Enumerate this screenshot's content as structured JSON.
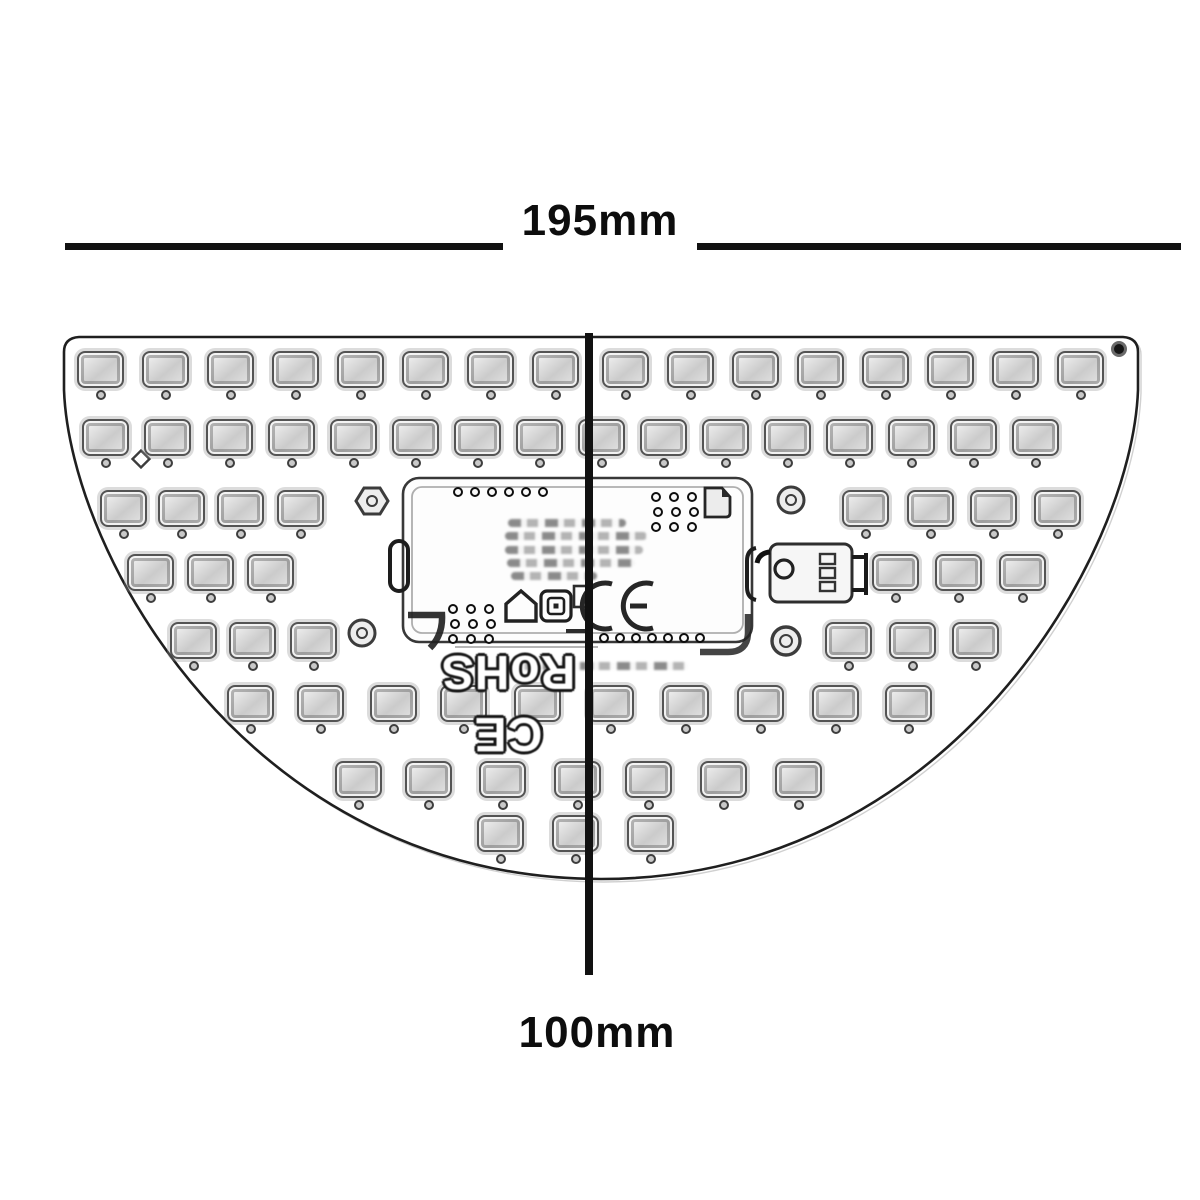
{
  "page": {
    "type": "technical-dimension-diagram",
    "subject": "Semicircular LED module PCB, sketch-style line drawing",
    "background": "#ffffff"
  },
  "dimensions": {
    "width_label": "195mm",
    "height_label": "100mm"
  },
  "board": {
    "shape": "half-moon (flat top edge, circular bottom arc)",
    "silkscreen_text": "CE RoHS",
    "silkscreen_rotation_deg": 180,
    "ce_mark": "CE",
    "icons": [
      "house-icon",
      "square-spiral-icon",
      "enclosure-icon",
      "page-curl-icon",
      "ce-mark-icon"
    ],
    "led_rows": [
      {
        "cy": 369,
        "cx": [
          100,
          165,
          230,
          295,
          360,
          425,
          490,
          555,
          625,
          690,
          755,
          820,
          885,
          950,
          1015,
          1080
        ]
      },
      {
        "cy": 437,
        "cx": [
          105,
          167,
          229,
          291,
          353,
          415,
          477,
          539,
          601,
          663,
          725,
          787,
          849,
          911,
          973,
          1035
        ]
      },
      {
        "cy": 508,
        "cx": [
          123,
          181,
          240,
          300,
          865,
          930,
          993,
          1057
        ]
      },
      {
        "cy": 572,
        "cx": [
          150,
          210,
          270,
          895,
          958,
          1022
        ]
      },
      {
        "cy": 640,
        "cx": [
          193,
          252,
          313,
          848,
          912,
          975
        ]
      },
      {
        "cy": 703,
        "cx": [
          250,
          320,
          393,
          463,
          537,
          610,
          685,
          760,
          835,
          908
        ]
      },
      {
        "cy": 779,
        "cx": [
          358,
          428,
          502,
          577,
          648,
          723,
          798
        ]
      },
      {
        "cy": 833,
        "cx": [
          500,
          575,
          650
        ]
      }
    ],
    "via_rows": [
      {
        "cy": 492,
        "cx": [
          458,
          475,
          492,
          509,
          526,
          543
        ]
      },
      {
        "cy": 638,
        "cx": [
          604,
          620,
          636,
          652,
          668,
          684,
          700
        ]
      }
    ],
    "via_grids": [
      {
        "x0": 656,
        "y0": 497,
        "dx": 18,
        "dy": 15,
        "cols": 3,
        "rows": 3
      },
      {
        "x0": 453,
        "y0": 609,
        "dx": 18,
        "dy": 15,
        "cols": 3,
        "rows": 3
      }
    ],
    "driver_text_lines": [
      {
        "x": 508,
        "y": 519,
        "w": 118
      },
      {
        "x": 505,
        "y": 532,
        "w": 142
      },
      {
        "x": 505,
        "y": 546,
        "w": 138
      },
      {
        "x": 507,
        "y": 559,
        "w": 128
      },
      {
        "x": 511,
        "y": 572,
        "w": 86
      }
    ],
    "bottom_text_line": {
      "x": 506,
      "y": 662,
      "w": 182
    }
  },
  "colors": {
    "ink": "#111111",
    "sketch_dark": "#2e2e2e",
    "sketch_mid": "#4a4a4a",
    "pad_fill": "#d6d6d6"
  }
}
